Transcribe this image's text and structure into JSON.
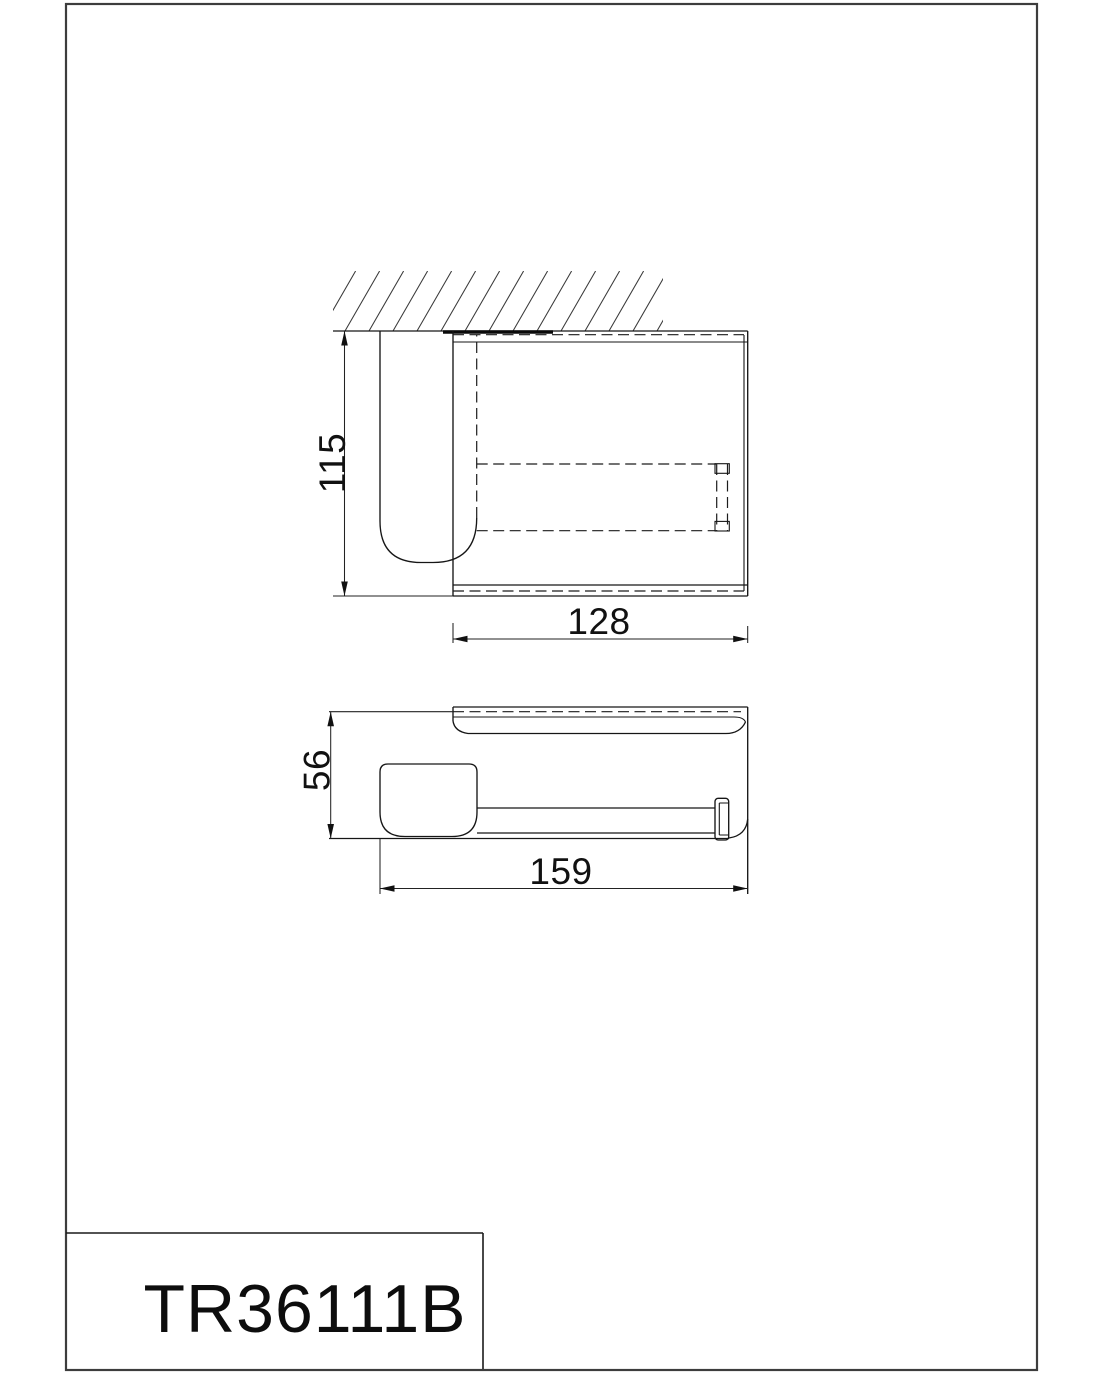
{
  "page": {
    "background": "#ffffff",
    "line_color": "#161616"
  },
  "title_block": {
    "product_code": "TR36111B"
  },
  "front_view": {
    "height_dim": "115",
    "width_dim": "128"
  },
  "top_view": {
    "depth_dim": "56",
    "width_dim": "159"
  }
}
